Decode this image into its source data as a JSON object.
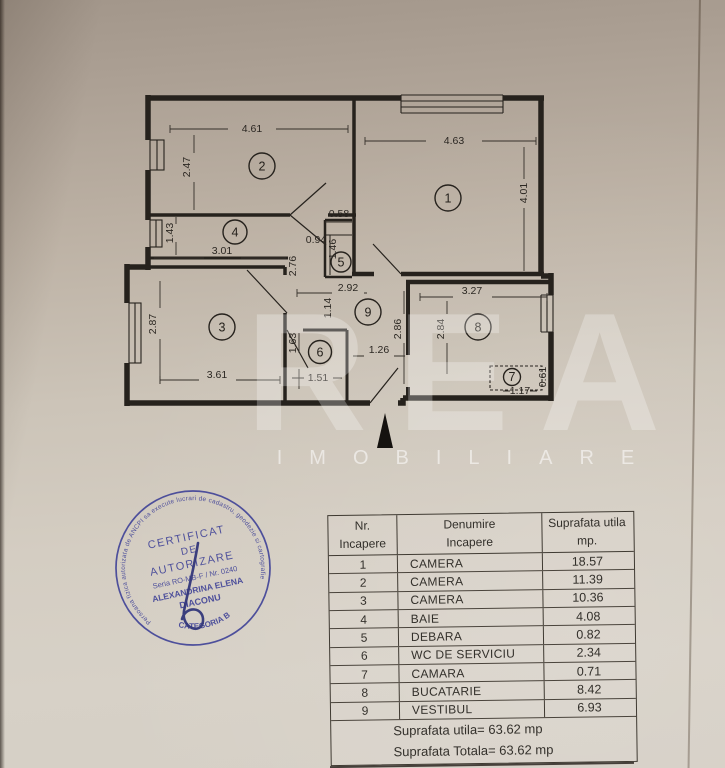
{
  "plan": {
    "rooms": {
      "r1": {
        "num": "1",
        "w": "4.63",
        "h": "4.01"
      },
      "r2": {
        "num": "2",
        "w": "4.61",
        "h": "2.47"
      },
      "r3": {
        "num": "3",
        "w": "3.61",
        "h": "2.87"
      },
      "r4": {
        "num": "4",
        "w": "3.01",
        "h": "1.43"
      },
      "r5": {
        "num": "5",
        "w": "0.58",
        "h": "1.46"
      },
      "r6": {
        "num": "6",
        "w": "1.51",
        "h": "1.63"
      },
      "r7": {
        "num": "7",
        "w": "1.17",
        "h": "0.61"
      },
      "r8": {
        "num": "8",
        "w": "3.27",
        "h": "2.84"
      },
      "r9": {
        "num": "9",
        "w": "2.92",
        "h": "2.86"
      }
    },
    "extra": {
      "e094": "0.94",
      "e276": "2.76",
      "e114": "1.14",
      "e126": "1.26"
    }
  },
  "watermark": {
    "logo": "REA",
    "subtitle": "IMOBILIARE"
  },
  "stamp": {
    "ring_text": "Persoana fizica autorizata de ANCPI sa execute lucrari de cadastru, geodezie si cartografie",
    "line1": "CERTIFICAT",
    "line2": "DE",
    "line3": "AUTORIZARE",
    "line4": "Seria RO-MB-F / Nr. 0240",
    "line5": "ALEXANDRINA ELENA",
    "line6": "DIACONU",
    "bottom": "CATEGORIA B",
    "color": "#3b3e96"
  },
  "table": {
    "headers": {
      "col1_line1": "Nr.",
      "col1_line2": "Incapere",
      "col2_line1": "Denumire",
      "col2_line2": "Incapere",
      "col3_line1": "Suprafata utila",
      "col3_line2": "mp."
    },
    "rows": [
      {
        "nr": "1",
        "name": "CAMERA",
        "area": "18.57"
      },
      {
        "nr": "2",
        "name": "CAMERA",
        "area": "11.39"
      },
      {
        "nr": "3",
        "name": "CAMERA",
        "area": "10.36"
      },
      {
        "nr": "4",
        "name": "BAIE",
        "area": "4.08"
      },
      {
        "nr": "5",
        "name": "DEBARA",
        "area": "0.82"
      },
      {
        "nr": "6",
        "name": "WC DE SERVICIU",
        "area": "2.34"
      },
      {
        "nr": "7",
        "name": "CAMARA",
        "area": "0.71"
      },
      {
        "nr": "8",
        "name": "BUCATARIE",
        "area": "8.42"
      },
      {
        "nr": "9",
        "name": "VESTIBUL",
        "area": "6.93"
      }
    ],
    "footer": {
      "line1": "Suprafata utila= 63.62 mp",
      "line2": "Suprafata Totala= 63.62 mp"
    }
  }
}
